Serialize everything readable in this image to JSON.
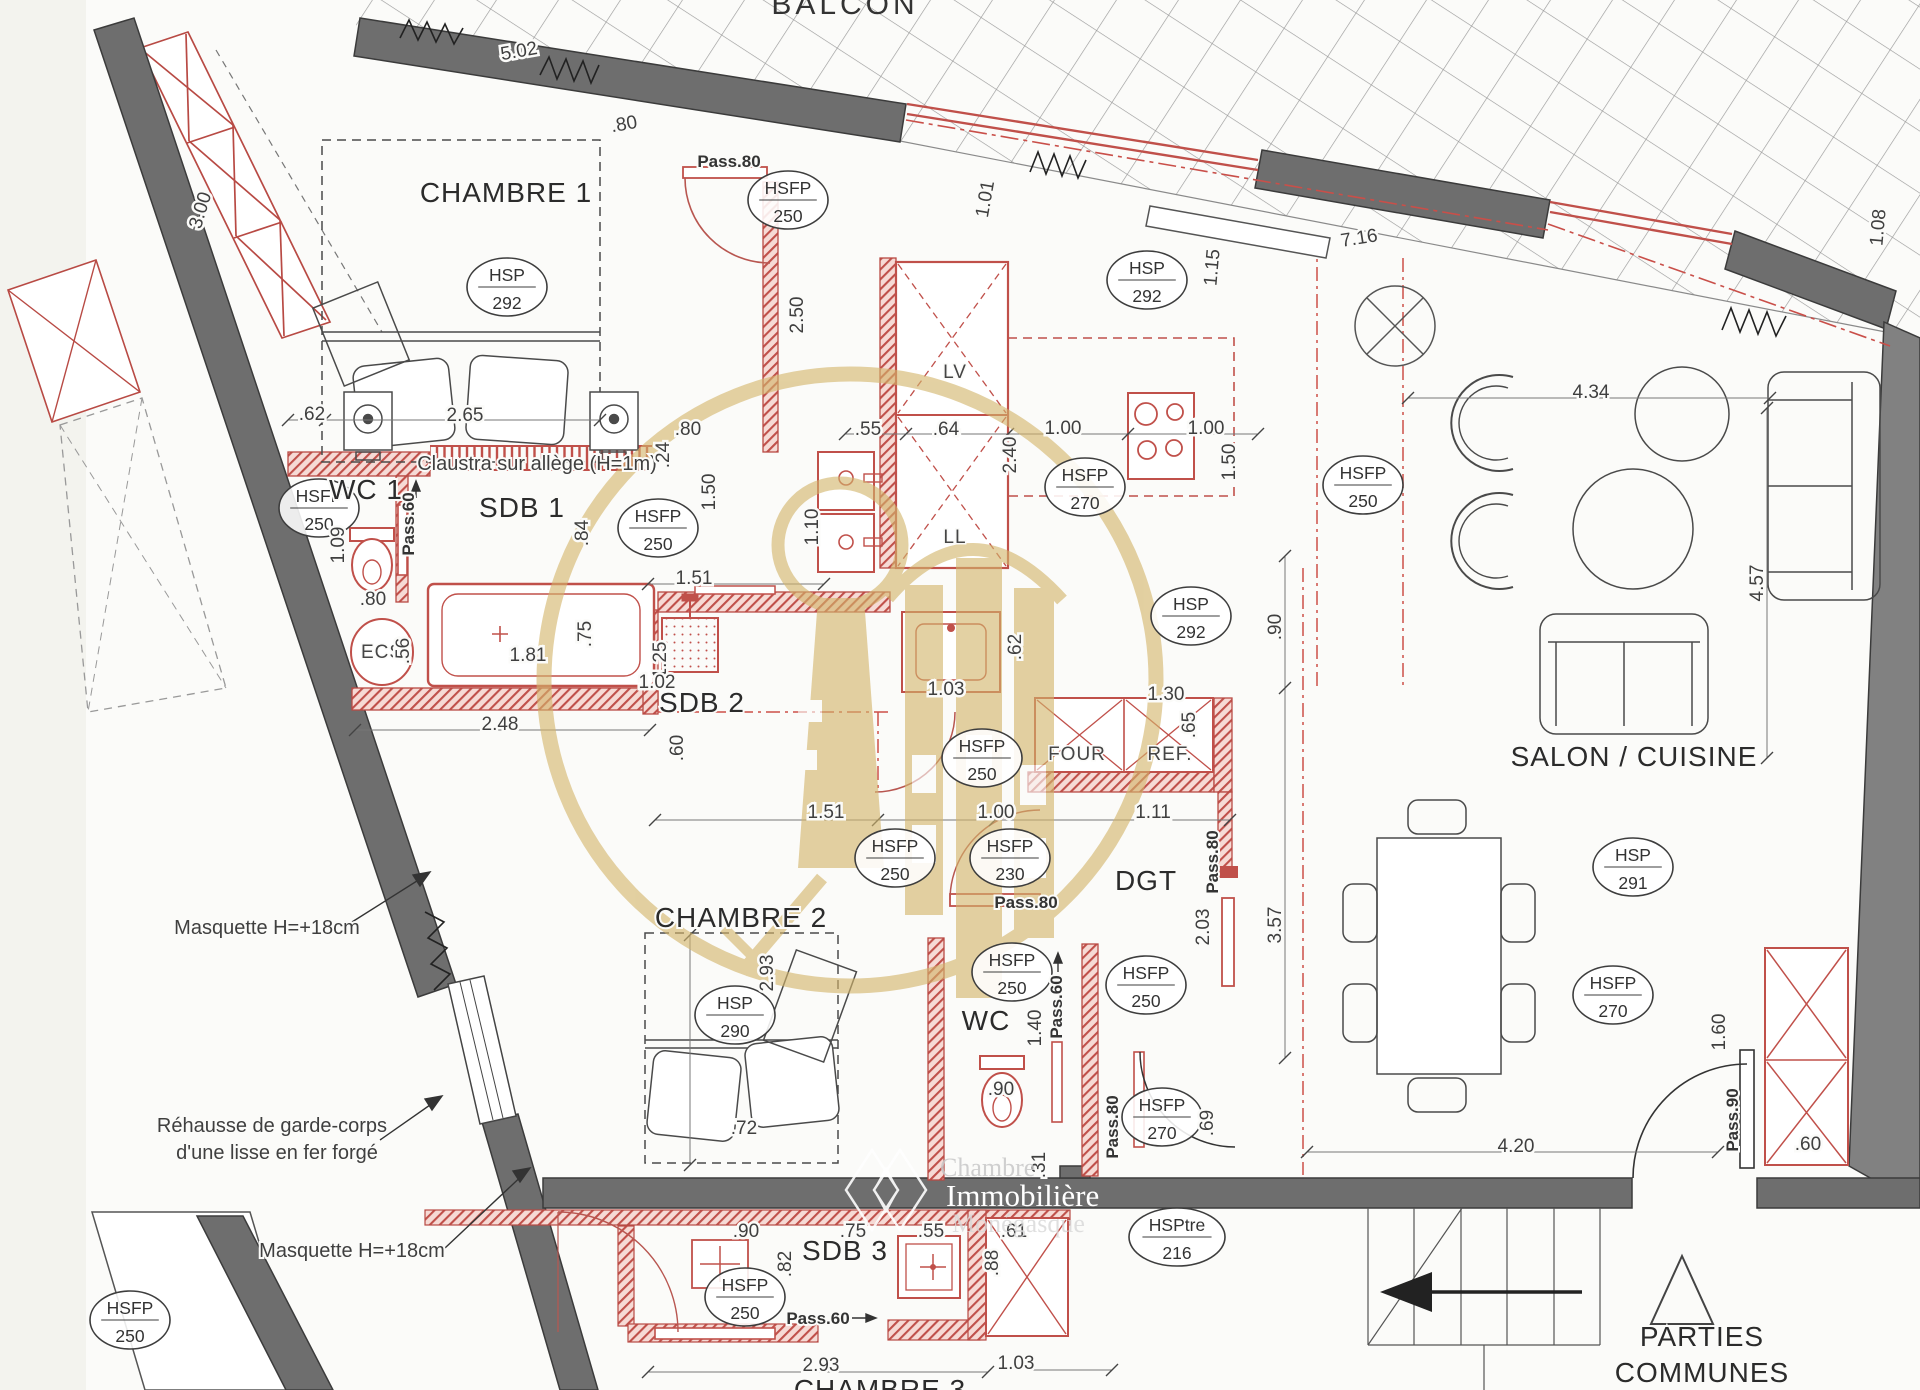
{
  "document": {
    "type": "architectural floor plan"
  },
  "watermark": {
    "org": [
      "Chambre",
      "Immobilière",
      "Monégasque"
    ]
  },
  "plan": {
    "texts": [
      {
        "t": "BALCON",
        "x": 845,
        "y": 14,
        "c": "balcon",
        "n": "room-label-balcon"
      },
      {
        "t": "CHAMBRE 1",
        "x": 506,
        "y": 202,
        "c": "room",
        "s": 30,
        "n": "room-label-chambre1"
      },
      {
        "t": "WC 1",
        "x": 366,
        "y": 499,
        "c": "room",
        "s": 26,
        "n": "room-label-wc1"
      },
      {
        "t": "SDB 1",
        "x": 522,
        "y": 517,
        "c": "room",
        "n": "room-label-sdb1"
      },
      {
        "t": "SDB 2",
        "x": 702,
        "y": 712,
        "c": "room",
        "s": 30,
        "n": "room-label-sdb2"
      },
      {
        "t": "CHAMBRE 2",
        "x": 741,
        "y": 927,
        "c": "room",
        "n": "room-label-chambre2"
      },
      {
        "t": "WC",
        "x": 986,
        "y": 1030,
        "c": "room",
        "n": "room-label-wc"
      },
      {
        "t": "DGT",
        "x": 1146,
        "y": 890,
        "c": "room",
        "n": "room-label-dgt"
      },
      {
        "t": "SALON / CUISINE",
        "x": 1634,
        "y": 766,
        "c": "room",
        "n": "room-label-salon-cuisine"
      },
      {
        "t": "SDB 3",
        "x": 845,
        "y": 1260,
        "c": "room",
        "n": "room-label-sdb3"
      },
      {
        "t": "CHAMBRE 3",
        "x": 880,
        "y": 1399,
        "c": "room",
        "n": "room-label-chambre3"
      },
      {
        "t": "PARTIES",
        "x": 1702,
        "y": 1346,
        "c": "room",
        "s": 26,
        "n": "room-label-parties"
      },
      {
        "t": "COMMUNES",
        "x": 1702,
        "y": 1382,
        "c": "room",
        "s": 26,
        "n": "room-label-communes"
      },
      {
        "t": "LV",
        "x": 955,
        "y": 378,
        "c": "app",
        "n": "appliance-label-lv"
      },
      {
        "t": "LL",
        "x": 955,
        "y": 543,
        "c": "app",
        "n": "appliance-label-ll"
      },
      {
        "t": "FOUR",
        "x": 1077,
        "y": 760,
        "c": "app",
        "n": "appliance-label-four"
      },
      {
        "t": "REF.",
        "x": 1170,
        "y": 760,
        "c": "app",
        "n": "appliance-label-ref"
      },
      {
        "t": "ECS",
        "x": 382,
        "y": 658,
        "c": "app",
        "s": 22,
        "n": "appliance-label-ecs"
      },
      {
        "t": "Masquette H=+18cm",
        "x": 267,
        "y": 934,
        "c": "ann",
        "n": "annotation-masquette-1"
      },
      {
        "t": "Réhausse de garde-corps",
        "x": 272,
        "y": 1132,
        "c": "ann",
        "n": "annotation-rehausse-1"
      },
      {
        "t": "d'une lisse en fer forgé",
        "x": 277,
        "y": 1159,
        "c": "ann",
        "n": "annotation-rehausse-2"
      },
      {
        "t": "Masquette H=+18cm",
        "x": 352,
        "y": 1257,
        "c": "ann",
        "n": "annotation-masquette-2"
      },
      {
        "t": "Claustra sur allège (H=1m)",
        "x": 537,
        "y": 470,
        "c": "ann",
        "s": 19,
        "n": "annotation-claustra"
      },
      {
        "t": "Pass.80",
        "x": 729,
        "y": 167,
        "c": "pass"
      },
      {
        "t": "Pass.60",
        "x": 414,
        "y": 524,
        "r": -90,
        "c": "pass"
      },
      {
        "t": "Pass.80",
        "x": 1026,
        "y": 908,
        "c": "pass"
      },
      {
        "t": "Pass.80",
        "x": 1218,
        "y": 862,
        "r": -90,
        "c": "pass"
      },
      {
        "t": "Pass.60",
        "x": 1062,
        "y": 1007,
        "r": -90,
        "c": "pass"
      },
      {
        "t": "Pass.80",
        "x": 1118,
        "y": 1127,
        "r": -90,
        "c": "pass"
      },
      {
        "t": "Pass.90",
        "x": 1738,
        "y": 1120,
        "r": -90,
        "c": "pass"
      },
      {
        "t": "Pass.60",
        "x": 818,
        "y": 1324,
        "c": "pass"
      },
      {
        "t": "5.02",
        "x": 520,
        "y": 57,
        "r": -10
      },
      {
        "t": ".80",
        "x": 625,
        "y": 130,
        "r": -10
      },
      {
        "t": "3.00",
        "x": 206,
        "y": 212,
        "r": -73
      },
      {
        "t": "2.65",
        "x": 465,
        "y": 421
      },
      {
        "t": ".62",
        "x": 312,
        "y": 420
      },
      {
        "t": ".80",
        "x": 688,
        "y": 435
      },
      {
        "t": ".55",
        "x": 868,
        "y": 435
      },
      {
        "t": ".64",
        "x": 946,
        "y": 435
      },
      {
        "t": "1.00",
        "x": 1063,
        "y": 434
      },
      {
        "t": "1.00",
        "x": 1206,
        "y": 434
      },
      {
        "t": "2.40",
        "x": 1016,
        "y": 455,
        "r": -90
      },
      {
        "t": "1.50",
        "x": 1235,
        "y": 462,
        "r": -90
      },
      {
        "t": "2.50",
        "x": 803,
        "y": 315,
        "r": -90
      },
      {
        "t": "1.10",
        "x": 818,
        "y": 527,
        "r": -90
      },
      {
        "t": "1.01",
        "x": 991,
        "y": 200,
        "r": -80
      },
      {
        "t": "1.15",
        "x": 1218,
        "y": 268,
        "r": -85
      },
      {
        "t": "7.16",
        "x": 1360,
        "y": 244,
        "r": -9
      },
      {
        "t": "1.08",
        "x": 1884,
        "y": 228,
        "r": -85
      },
      {
        "t": "1.09",
        "x": 344,
        "y": 545,
        "r": -90
      },
      {
        "t": ".80",
        "x": 373,
        "y": 605
      },
      {
        "t": ".56",
        "x": 409,
        "y": 651,
        "r": -90
      },
      {
        "t": ".24",
        "x": 669,
        "y": 455,
        "r": -90
      },
      {
        "t": "1.50",
        "x": 715,
        "y": 492,
        "r": -90
      },
      {
        "t": ".84",
        "x": 588,
        "y": 533,
        "r": -90
      },
      {
        "t": "1.51",
        "x": 694,
        "y": 584
      },
      {
        "t": "1.81",
        "x": 528,
        "y": 661
      },
      {
        "t": ".75",
        "x": 591,
        "y": 634,
        "r": -90
      },
      {
        "t": "1.25",
        "x": 666,
        "y": 660,
        "r": -90
      },
      {
        "t": "2.48",
        "x": 500,
        "y": 730
      },
      {
        "t": ".60",
        "x": 683,
        "y": 748,
        "r": -90
      },
      {
        "t": "1.02",
        "x": 657,
        "y": 688
      },
      {
        "t": "1.03",
        "x": 946,
        "y": 695
      },
      {
        "t": ".62",
        "x": 1021,
        "y": 647,
        "r": -90
      },
      {
        "t": "1.30",
        "x": 1166,
        "y": 700
      },
      {
        "t": ".65",
        "x": 1195,
        "y": 725,
        "r": -90
      },
      {
        "t": "1.51",
        "x": 826,
        "y": 818
      },
      {
        "t": "1.00",
        "x": 996,
        "y": 818
      },
      {
        "t": "1.11",
        "x": 1153,
        "y": 818
      },
      {
        "t": ".90",
        "x": 1281,
        "y": 627,
        "r": -90
      },
      {
        "t": "4.34",
        "x": 1591,
        "y": 398
      },
      {
        "t": "4.57",
        "x": 1763,
        "y": 583,
        "r": -90
      },
      {
        "t": "2.93",
        "x": 773,
        "y": 973,
        "r": -90
      },
      {
        "t": ".72",
        "x": 744,
        "y": 1134
      },
      {
        "t": "2.03",
        "x": 1209,
        "y": 927,
        "r": -90
      },
      {
        "t": "3.57",
        "x": 1281,
        "y": 925,
        "r": -90
      },
      {
        "t": "1.40",
        "x": 1041,
        "y": 1028,
        "r": -90
      },
      {
        "t": ".90",
        "x": 1001,
        "y": 1095
      },
      {
        "t": ".31",
        "x": 1045,
        "y": 1165,
        "r": -90
      },
      {
        "t": ".69",
        "x": 1213,
        "y": 1123,
        "r": -90
      },
      {
        "t": "1.60",
        "x": 1725,
        "y": 1032,
        "r": -90
      },
      {
        "t": ".60",
        "x": 1808,
        "y": 1150
      },
      {
        "t": "4.20",
        "x": 1516,
        "y": 1152
      },
      {
        "t": ".90",
        "x": 746,
        "y": 1237
      },
      {
        "t": ".75",
        "x": 853,
        "y": 1237
      },
      {
        "t": ".55",
        "x": 931,
        "y": 1237
      },
      {
        "t": ".61",
        "x": 1014,
        "y": 1237
      },
      {
        "t": ".82",
        "x": 791,
        "y": 1264,
        "r": -90
      },
      {
        "t": ".88",
        "x": 998,
        "y": 1263,
        "r": -90
      },
      {
        "t": "2.93",
        "x": 821,
        "y": 1371
      },
      {
        "t": "1.03",
        "x": 1016,
        "y": 1369
      },
      {
        "t": "Chambre",
        "x": 940,
        "y": 1176,
        "s": 26,
        "c": "wmt",
        "n": "watermark-text-1"
      },
      {
        "t": "Immobilière",
        "x": 946,
        "y": 1206,
        "s": 31,
        "c": "wmt2",
        "n": "watermark-text-2"
      },
      {
        "t": "Monégasque",
        "x": 952,
        "y": 1232,
        "s": 26,
        "c": "wmt3",
        "n": "watermark-text-3"
      }
    ],
    "badges": [
      {
        "x": 788,
        "y": 200,
        "a": "HSFP",
        "b": "250"
      },
      {
        "x": 1147,
        "y": 280,
        "a": "HSP",
        "b": "292"
      },
      {
        "x": 319,
        "y": 508,
        "a": "HSFP",
        "b": "250"
      },
      {
        "x": 658,
        "y": 528,
        "a": "HSFP",
        "b": "250"
      },
      {
        "x": 1085,
        "y": 487,
        "a": "HSFP",
        "b": "270"
      },
      {
        "x": 1363,
        "y": 485,
        "a": "HSFP",
        "b": "250"
      },
      {
        "x": 1191,
        "y": 616,
        "a": "HSP",
        "b": "292"
      },
      {
        "x": 982,
        "y": 758,
        "a": "HSFP",
        "b": "250"
      },
      {
        "x": 895,
        "y": 858,
        "a": "HSFP",
        "b": "250"
      },
      {
        "x": 1010,
        "y": 858,
        "a": "HSFP",
        "b": "230"
      },
      {
        "x": 1146,
        "y": 985,
        "a": "HSFP",
        "b": "250"
      },
      {
        "x": 1012,
        "y": 972,
        "a": "HSFP",
        "b": "250"
      },
      {
        "x": 735,
        "y": 1015,
        "a": "HSP",
        "b": "290"
      },
      {
        "x": 1162,
        "y": 1117,
        "a": "HSFP",
        "b": "270"
      },
      {
        "x": 1177,
        "y": 1237,
        "a": "HSPtre",
        "b": "216",
        "w": 48
      },
      {
        "x": 1613,
        "y": 995,
        "a": "HSFP",
        "b": "270"
      },
      {
        "x": 1633,
        "y": 867,
        "a": "HSP",
        "b": "291"
      },
      {
        "x": 507,
        "y": 287,
        "a": "HSP",
        "b": "292"
      },
      {
        "x": 745,
        "y": 1297,
        "a": "HSFP",
        "b": "250"
      },
      {
        "x": 130,
        "y": 1320,
        "a": "HSFP",
        "b": "250"
      }
    ],
    "colors": {
      "wall": "#6e6e6e",
      "partition": "#c0504a",
      "watermark_gold": "#d3b56b",
      "paper": "#fbfbf9"
    }
  }
}
